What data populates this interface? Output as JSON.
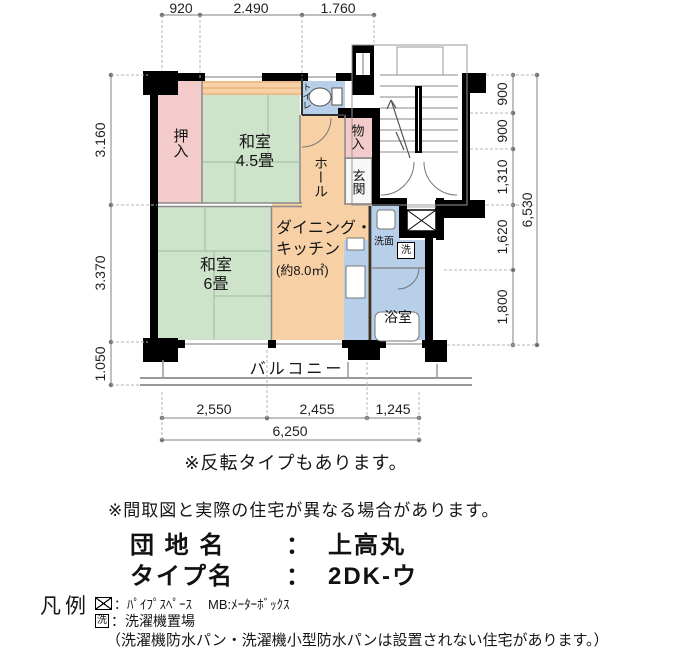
{
  "plan": {
    "rooms": {
      "oshiire": "押入",
      "washitsu45_name": "和室",
      "washitsu45_size": "4.5畳",
      "toilet": "トイレ",
      "hall": "ホール",
      "monoire": "物入",
      "genkan": "玄関",
      "washitsu6_name": "和室",
      "washitsu6_size": "6畳",
      "dk_line1": "ダイニング・",
      "dk_line2": "キッチン",
      "dk_line3": "(約8.0㎡)",
      "senmen": "洗面",
      "laundry": "洗",
      "bath": "浴室",
      "balcony": "バルコニー"
    },
    "dims": {
      "top": [
        "920",
        "2.490",
        "1.760"
      ],
      "left": [
        "3.160",
        "3.370",
        "1.050"
      ],
      "right": [
        "900",
        "900",
        "1,310",
        "1,620",
        "1,800"
      ],
      "right_total": "6,530",
      "bottom": [
        "2,550",
        "2,455",
        "1,245"
      ],
      "bottom_total": "6,250"
    }
  },
  "notes": {
    "reverse": "※反転タイプもあります。",
    "disclaimer": "※間取図と実際の住宅が異なる場合があります。"
  },
  "info": {
    "estate_label": "団 地 名",
    "estate_colon": "：",
    "estate_value": "上高丸",
    "type_label": "タイプ名",
    "type_colon": "：",
    "type_value": "2DK-ウ"
  },
  "legend": {
    "title": "凡例",
    "pipe_space": "：ﾊﾟｲﾌﾟｽﾍﾟｰｽ",
    "meter_box": "MB:ﾒｰﾀｰﾎﾞｯｸｽ",
    "laundry_symbol": "洗",
    "laundry_label": "：洗濯機置場",
    "laundry_note": "（洗濯機防水パン・洗濯機小型防水パンは設置されない住宅があります。）"
  },
  "colors": {
    "tatami_green": "#cde3ca",
    "closet_pink": "#f4cbcb",
    "dk_orange": "#f7d0a5",
    "wet_area_blue": "#b7cfe9",
    "wall_black": "#000000"
  }
}
